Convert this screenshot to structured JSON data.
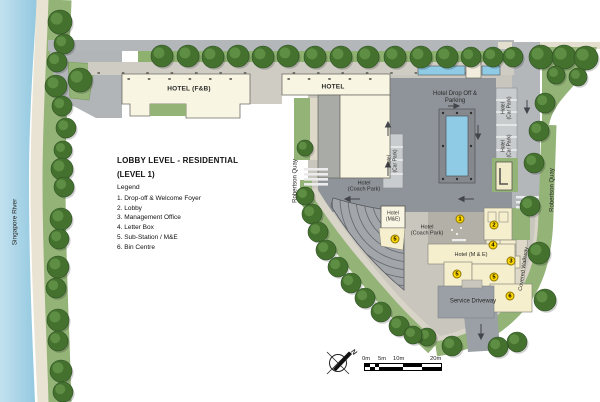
{
  "legend": {
    "title_line1": "LOBBY LEVEL - RESIDENTIAL",
    "title_line2": "(LEVEL 1)",
    "heading": "Legend",
    "items": [
      "1. Drop-off & Welcome Foyer",
      "2. Lobby",
      "3. Management Office",
      "4. Letter Box",
      "5. Sub-Station / M&E",
      "6. Bin Centre"
    ]
  },
  "labels": {
    "singapore_river": "Singapore River",
    "robertson_quay_west": "Robertson Quay",
    "robertson_quay_east": "Robertson Quay",
    "covered_walkway": "Covered Walkway",
    "hotel_fnb": "HOTEL (F&B)",
    "hotel": "HOTEL",
    "hotel_drop_off": "Hotel Drop Off &\nParking",
    "hotel_car_park_west": "Hotel\n(Car Park)",
    "hotel_car_park_east_upper": "Hotel\n(Car Park)",
    "hotel_car_park_east_lower": "Hotel\n(Car Park)",
    "hotel_coach_park_upper": "Hotel\n(Coach Park)",
    "hotel_coach_park_lower": "Hotel\n(Coach Park)",
    "hotel_me_box": "Hotel\n(M&E)",
    "hotel_m_e": "Hotel (M & E)",
    "service_driveway": "Service Driveway"
  },
  "markers": [
    {
      "n": "1",
      "x": 460,
      "y": 219
    },
    {
      "n": "2",
      "x": 494,
      "y": 225
    },
    {
      "n": "4",
      "x": 493,
      "y": 245
    },
    {
      "n": "3",
      "x": 511,
      "y": 261
    },
    {
      "n": "5",
      "x": 395,
      "y": 239
    },
    {
      "n": "5",
      "x": 457,
      "y": 274
    },
    {
      "n": "5",
      "x": 494,
      "y": 277
    },
    {
      "n": "6",
      "x": 510,
      "y": 296
    }
  ],
  "compass": {
    "north": "N"
  },
  "scale_bar": {
    "ticks": [
      "0m",
      "5m",
      "10m",
      "20m"
    ]
  },
  "colors": {
    "water": "#a9d4e6",
    "promenade": "#e9e3d3",
    "greenery": "#93b377",
    "tree": "#3c672f",
    "road": "#b4b7ba",
    "parking": "#8f949a",
    "sidewalk": "#c9c6bd",
    "building": "#f9f5e3",
    "residential": "#f6efcd",
    "marker_yellow": "#ffd800",
    "pool": "#8fcbe4"
  }
}
